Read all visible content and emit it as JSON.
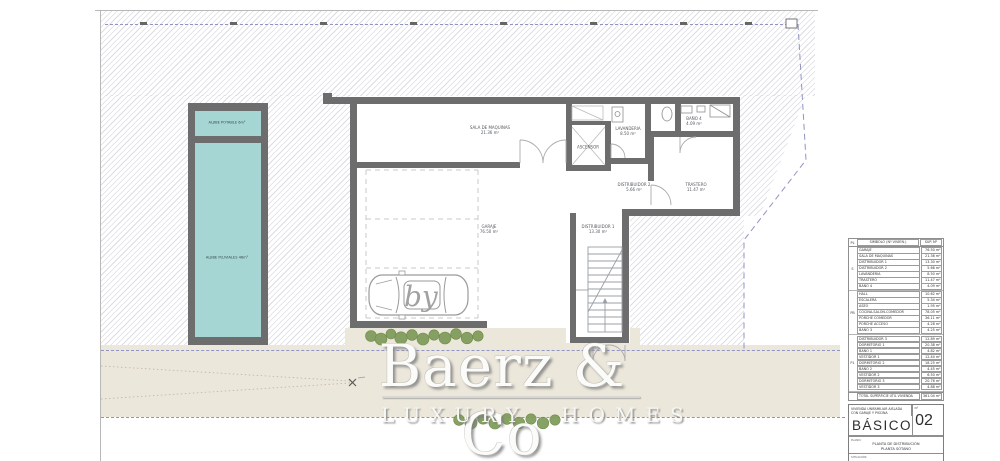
{
  "colors": {
    "wall": "#6d6d6d",
    "pool": "#a6d6d4",
    "beige": "#ece7db",
    "hatch": "#dcdce2",
    "dash": "#8f94c4",
    "bush": "#7d9b58",
    "line": "#a9a9a9"
  },
  "plan": {
    "pool": {
      "top_label": "ALJIBE POTABLE 6m²",
      "main_label": "ALJIBE PLUVIALES 46m²"
    },
    "rooms": [
      {
        "name": "SALA DE MAQUINAS",
        "area": "21.36 m²"
      },
      {
        "name": "GARAJE",
        "area": "76.50 m²"
      },
      {
        "name": "DISTRIBUIDOR 1",
        "area": "13.30 m²"
      },
      {
        "name": "ASCENSOR",
        "area": ""
      },
      {
        "name": "LAVANDERIA",
        "area": "8.50 m²"
      },
      {
        "name": "BAÑO 4",
        "area": "4.09 m²"
      },
      {
        "name": "DISTRIBUIDOR 2",
        "area": "5.66 m²"
      },
      {
        "name": "TRASTERO",
        "area": "11.47 m²"
      }
    ]
  },
  "watermark": {
    "by": "by",
    "brand": "Baerz & Co",
    "tagline": "LUXURY HOMES"
  },
  "area_table": {
    "header": {
      "col1": "PL",
      "col2": "SIMBOLO (Nº VIVIEN.)",
      "col3": "SUP. M²"
    },
    "groups": [
      {
        "label": "S",
        "rows": [
          {
            "name": "GARAJE",
            "value": "76.50 m²"
          },
          {
            "name": "SALA DE MAQUINAS",
            "value": "21.36 m²"
          },
          {
            "name": "DISTRIBUIDOR 1",
            "value": "13.30 m²"
          },
          {
            "name": "DISTRIBUIDOR 2",
            "value": "5.66 m²"
          },
          {
            "name": "LAVANDERIA",
            "value": "8.50 m²"
          },
          {
            "name": "TRASTERO",
            "value": "11.47 m²"
          },
          {
            "name": "BAÑO 4",
            "value": "4.09 m²"
          }
        ]
      },
      {
        "label": "PB",
        "rows": [
          {
            "name": "HALL",
            "value": "10.62 m²"
          },
          {
            "name": "ESCALERA",
            "value": "5.34 m²"
          },
          {
            "name": "ASEO",
            "value": "1.95 m²"
          },
          {
            "name": "COCINA-SALON-COMEDOR",
            "value": "78.05 m²"
          },
          {
            "name": "PORCHE COMEDOR",
            "value": "36.11 m²"
          },
          {
            "name": "PORCHE ACCESO",
            "value": "4.28 m²"
          },
          {
            "name": "BAÑO 3",
            "value": "4.25 m²"
          }
        ]
      },
      {
        "label": "P1",
        "rows": [
          {
            "name": "DISTRIBUIDOR 3",
            "value": "12.89 m²"
          },
          {
            "name": "DORMITORIO 1",
            "value": "20.38 m²"
          },
          {
            "name": "BAÑO 1",
            "value": "4.82 m²"
          },
          {
            "name": "VESTIDOR 1",
            "value": "12.44 m²"
          },
          {
            "name": "DORMITORIO 2",
            "value": "18.25 m²"
          },
          {
            "name": "BAÑO 2",
            "value": "4.45 m²"
          },
          {
            "name": "VESTIDOR 2",
            "value": "6.50 m²"
          },
          {
            "name": "DORMITORIO 3",
            "value": "20.76 m²"
          },
          {
            "name": "VESTIDOR 3",
            "value": "4.88 m²"
          }
        ]
      }
    ],
    "total": {
      "name": "TOTAL SUPERFICIE ÚTIL VIVIENDA",
      "value": "361.04 m²"
    }
  },
  "title_block": {
    "project_line1": "VIVIENDA UNIFAMILIAR AISLADA",
    "project_line2": "CON GARAJE Y PISCINA",
    "number_label": "Nº",
    "phase": "BÁSICO",
    "sheet_number": "02",
    "plan_label": "PLANO:",
    "plan_name_line1": "PLANTA DE DISTRIBUCIÓN",
    "plan_name_line2": "PLANTA SÓTANO",
    "bottom_label": "SITUACIÓN:"
  }
}
